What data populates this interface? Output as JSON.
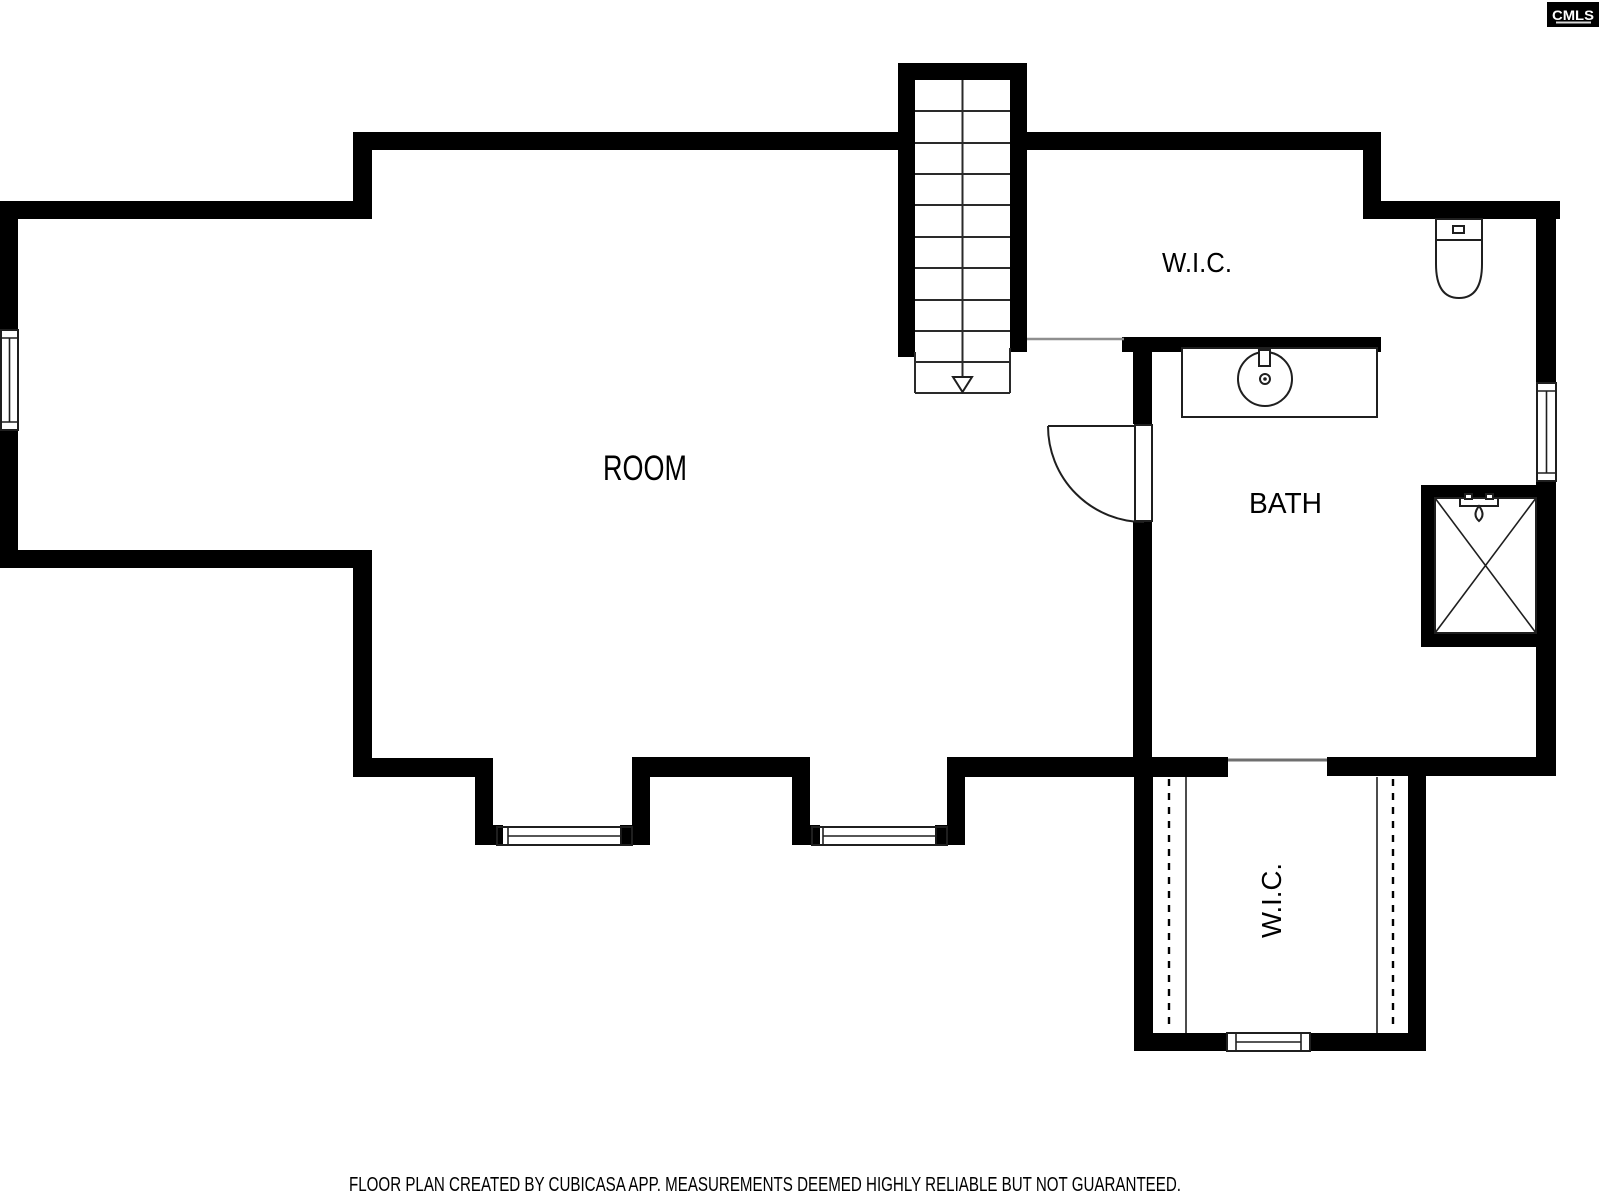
{
  "document": {
    "type": "floor-plan",
    "source_app": "CubiCasa",
    "background_color": "#ffffff",
    "wall_color": "#000000",
    "line_color": "#1f1f1f"
  },
  "logo": {
    "label": "CMLS",
    "bg": "#000000",
    "fg": "#ffffff"
  },
  "rooms": {
    "room": {
      "label": "ROOM"
    },
    "wic_top": {
      "label": "W.I.C."
    },
    "bath": {
      "label": "BATH"
    },
    "wic_bottom": {
      "label": "W.I.C."
    }
  },
  "fixtures": [
    "staircase-down-arrow",
    "toilet",
    "sink-vanity",
    "shower",
    "door-swing",
    "window",
    "closet-rails"
  ],
  "footer": {
    "disclaimer": "FLOOR PLAN CREATED BY CUBICASA APP. MEASUREMENTS DEEMED HIGHLY RELIABLE BUT NOT GUARANTEED."
  }
}
